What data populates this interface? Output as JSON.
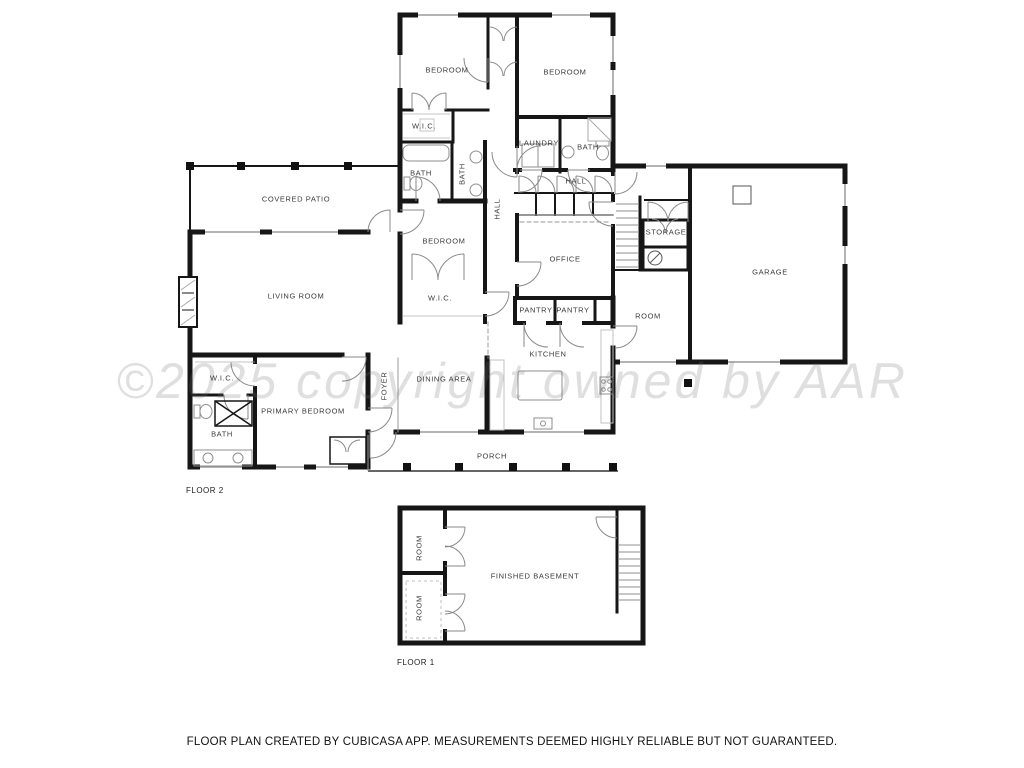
{
  "watermark": "©2025 copyright owned by AAR",
  "disclaimer": "FLOOR PLAN CREATED BY CUBICASA APP. MEASUREMENTS DEEMED HIGHLY RELIABLE BUT NOT GUARANTEED.",
  "floor2": {
    "label": "FLOOR 2",
    "rooms": [
      {
        "label": "BEDROOM"
      },
      {
        "label": "BEDROOM"
      },
      {
        "label": "W.I.C."
      },
      {
        "label": "BATH"
      },
      {
        "label": "BATH"
      },
      {
        "label": "LAUNDRY"
      },
      {
        "label": "BATH"
      },
      {
        "label": "HALL"
      },
      {
        "label": "COVERED PATIO"
      },
      {
        "label": "HALL"
      },
      {
        "label": "BEDROOM"
      },
      {
        "label": "STORAGE"
      },
      {
        "label": "OFFICE"
      },
      {
        "label": "GARAGE"
      },
      {
        "label": "LIVING ROOM"
      },
      {
        "label": "W.I.C."
      },
      {
        "label": "PANTRY"
      },
      {
        "label": "PANTRY"
      },
      {
        "label": "ROOM"
      },
      {
        "label": "KITCHEN"
      },
      {
        "label": "W.I.C."
      },
      {
        "label": "DINING AREA"
      },
      {
        "label": "FOYER"
      },
      {
        "label": "PRIMARY BEDROOM"
      },
      {
        "label": "BATH"
      },
      {
        "label": "PORCH"
      }
    ]
  },
  "floor1": {
    "label": "FLOOR 1",
    "rooms": [
      {
        "label": "ROOM"
      },
      {
        "label": "FINISHED BASEMENT"
      },
      {
        "label": "ROOM"
      }
    ]
  }
}
